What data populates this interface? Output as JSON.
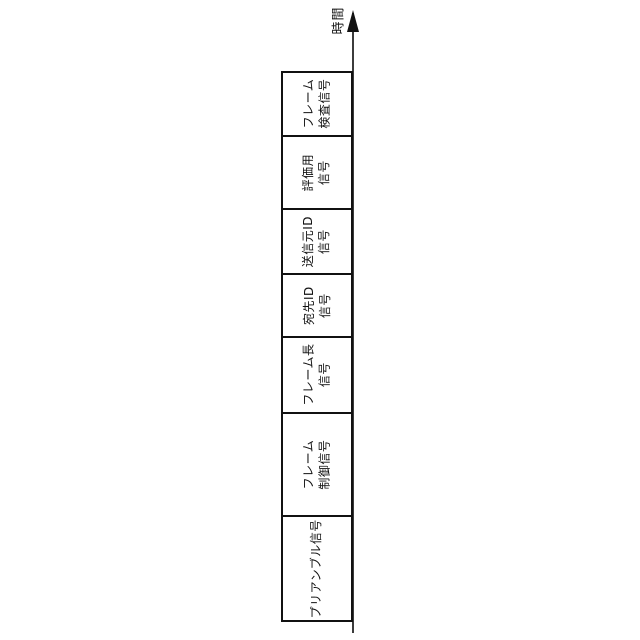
{
  "figure": {
    "background_color": "#ffffff",
    "line_color": "#111111",
    "axis": {
      "label": "時間",
      "arrow_direction": "up"
    },
    "frame_fields": [
      {
        "lines": [
          "フレーム",
          "検査信号"
        ]
      },
      {
        "lines": [
          "評価用",
          "信号"
        ]
      },
      {
        "lines": [
          "送信元ID",
          "信号"
        ]
      },
      {
        "lines": [
          "宛先ID",
          "信号"
        ]
      },
      {
        "lines": [
          "フレーム長",
          "信号"
        ]
      },
      {
        "lines": [
          "フレーム",
          "制御信号"
        ]
      },
      {
        "lines": [
          "プリアンブル信号"
        ]
      }
    ]
  }
}
